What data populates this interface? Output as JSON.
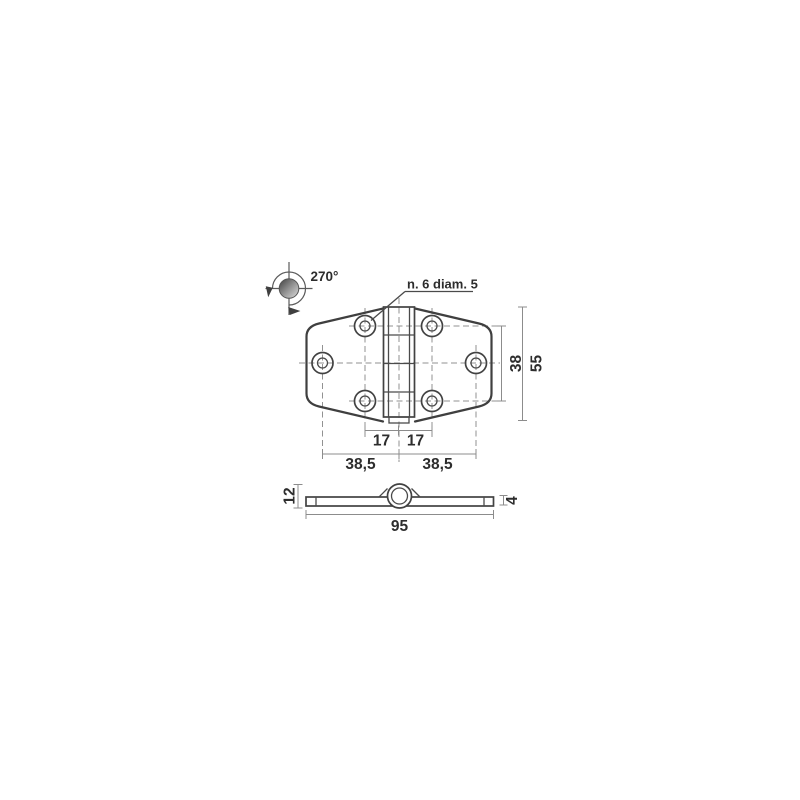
{
  "drawing": {
    "type": "hinge technical drawing, top view and side view",
    "colors": {
      "background": "#ffffff",
      "outline": "#3f3f3f",
      "dimension_lines": "#8c8c8c",
      "centerlines": "#929292",
      "text": "#2d2d2d"
    },
    "rotation_symbol": {
      "angle_label": "270°"
    },
    "hole_note": {
      "label": "n. 6 diam. 5"
    },
    "top_view": {
      "dims": {
        "pitch_left": "17",
        "pitch_right": "17",
        "outer_left": "38,5",
        "outer_right": "38,5",
        "row_spacing": "38",
        "height": "55"
      }
    },
    "side_view": {
      "dims": {
        "knuckle_height": "12",
        "leaf_thickness": "4",
        "length": "95"
      }
    }
  }
}
